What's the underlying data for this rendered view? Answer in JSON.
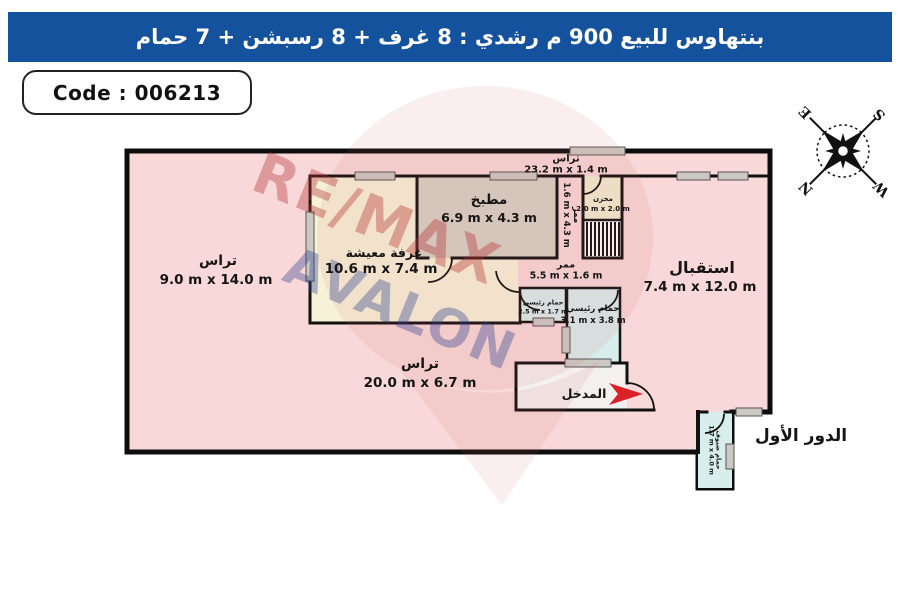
{
  "header": {
    "title": "بنتهاوس للبيع 900 م رشدي  :  8 غرف + 8 رسبشن + 7 حمام",
    "bg_color": "#14529e"
  },
  "code_box": {
    "label": "Code : 006213"
  },
  "floor_label": "الدور الأول",
  "entrance": {
    "label": "المدخل",
    "arrow_color": "#da2127"
  },
  "watermark": {
    "line1": "RE/MAX",
    "line2": "AVALON",
    "red": "#b73438",
    "blue": "#2b3d8f"
  },
  "compass": {
    "n": "N",
    "s": "S",
    "e": "E",
    "w": "W"
  },
  "rooms": {
    "terrace_top": {
      "name": "تراس",
      "dims": "23.2 m x 1.4 m"
    },
    "terrace_left": {
      "name": "تراس",
      "dims": "9.0 m x 14.0 m"
    },
    "terrace_bottom": {
      "name": "تراس",
      "dims": "20.0 m x 6.7 m"
    },
    "living": {
      "name": "غرفة معيشة",
      "dims": "10.6 m x 7.4 m"
    },
    "kitchen": {
      "name": "مطبخ",
      "dims": "6.9 m x 4.3 m"
    },
    "corridor_v": {
      "name": "ممر",
      "dims": "1.6 m x 4.3 m"
    },
    "storage": {
      "name": "مخزن",
      "dims": "2.0 m x 2.0 m"
    },
    "corridor_h": {
      "name": "ممر",
      "dims": "5.5 m x 1.6 m"
    },
    "bath_main_small": {
      "name": "حمام رئيسي",
      "dims": "2.5 m x 1.7 m"
    },
    "bath_main": {
      "name": "حمام رئيسي",
      "dims": "3.1 m x 3.8 m"
    },
    "reception": {
      "name": "استقبال",
      "dims": "7.4 m x 12.0 m"
    },
    "bath_guest": {
      "name": "حمام ضيوف",
      "dims": "1.7 m x 4.0 m"
    }
  },
  "colors": {
    "plan_fill": "#f8d8d8",
    "cream": "#f6f2d8",
    "kitchen": "#d6d2c7",
    "storage": "#f2ecd2",
    "bath": "#d8eeec",
    "entrance": "#f3f0ef",
    "wall": "#111111",
    "window": "#ccc9c4"
  }
}
